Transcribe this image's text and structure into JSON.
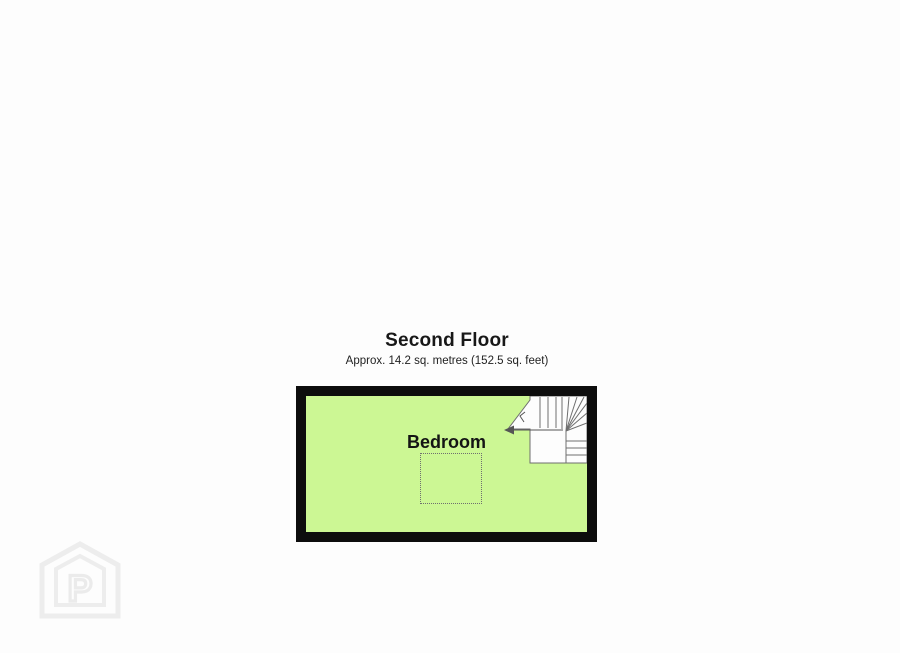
{
  "page": {
    "background_color": "#fdfdfd"
  },
  "plan": {
    "title": "Second Floor",
    "subtitle": "Approx. 14.2 sq. metres (152.5 sq. feet)",
    "room_label": "Bedroom",
    "colors": {
      "room_fill": "#ccf794",
      "wall": "#0d0d0d",
      "stair_fill": "#fdfdfd",
      "stair_line": "#6e6e6e",
      "dashed_outline": "#6f6f6f",
      "label_text": "#141414",
      "watermark": "#ededed"
    }
  },
  "watermark": {
    "icon": "house-p-logo",
    "letter": "P"
  }
}
